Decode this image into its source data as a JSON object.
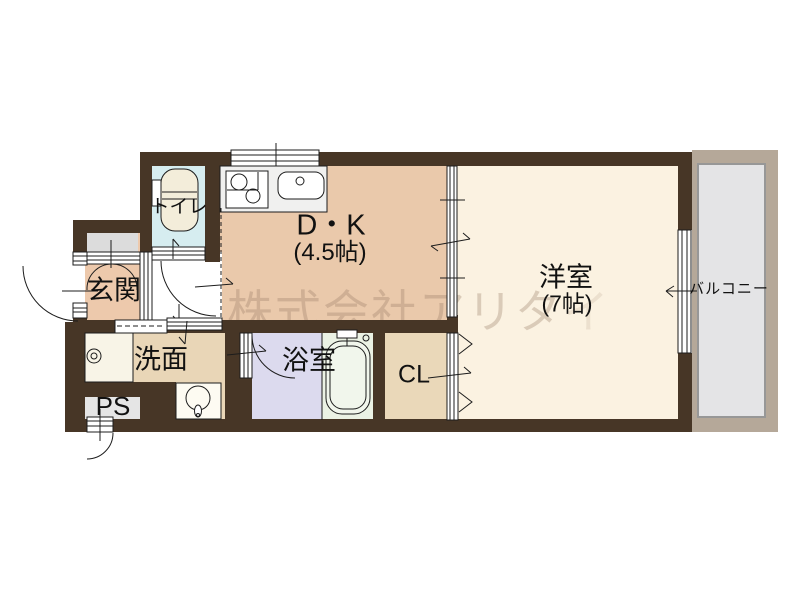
{
  "plan_type": "floorplan",
  "rooms": {
    "dk": {
      "label": "D・K",
      "size": "(4.5帖)"
    },
    "yoshitsu": {
      "label": "洋室",
      "size": "(7帖)"
    },
    "genkan": {
      "label": "玄関"
    },
    "toilet": {
      "label": "トイレ"
    },
    "senmen": {
      "label": "洗面"
    },
    "bath": {
      "label": "浴室"
    },
    "closet": {
      "label": "CL"
    },
    "ps": {
      "label": "PS"
    },
    "balcony": {
      "label": "バルコニー"
    }
  },
  "watermark": {
    "text": "株式会社アリタ",
    "tail": "イ"
  },
  "colors": {
    "wall": "#473626",
    "dk_floor": "#eac9ab",
    "yoshitsu_floor": "#fbf2e1",
    "toilet_floor": "#d6edf0",
    "bath_floor": "#dcdaee",
    "tub_area": "#ebf2e4",
    "senmen_floor": "#e9d6b7",
    "closet_floor": "#ead8b9",
    "ps_box": "#e5e5e5",
    "genkan_alcove": "#dcdcdc",
    "balcony_frame": "#b5a899",
    "balcony_floor": "#e4e4e6",
    "line": "#1c1c1c"
  }
}
